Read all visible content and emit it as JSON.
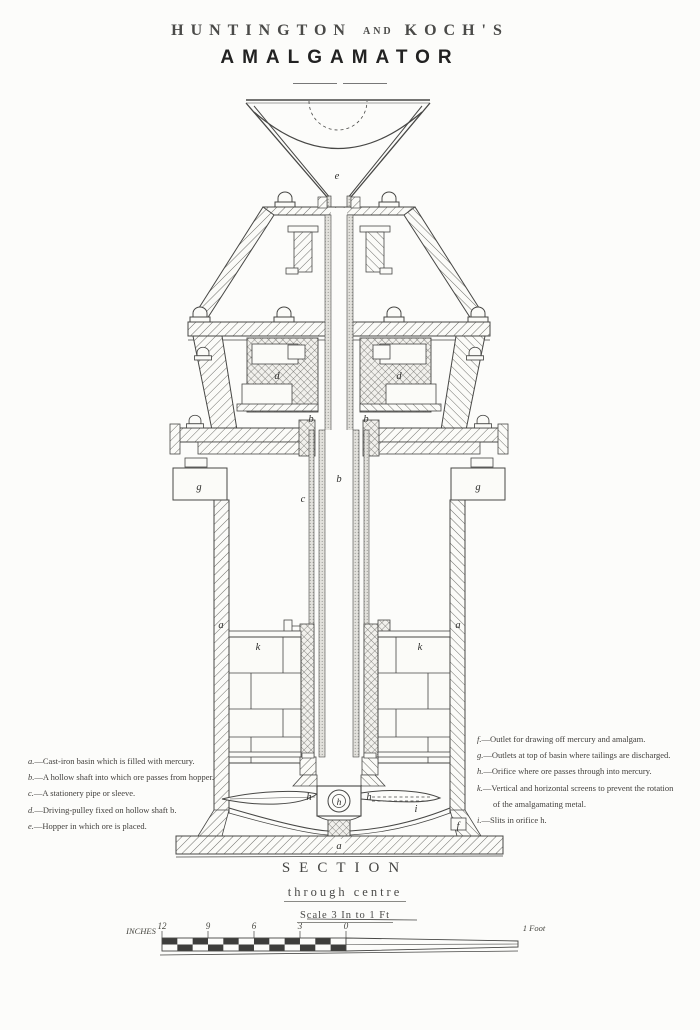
{
  "title": {
    "word1": "HUNTINGTON",
    "conj": "AND",
    "word2": "KOCH'S",
    "line2": "AMALGAMATOR"
  },
  "legend_left": [
    {
      "key": "a.",
      "text": "—Cast-iron basin which is filled with mercury."
    },
    {
      "key": "b.",
      "text": "—A hollow shaft into which ore passes from hopper."
    },
    {
      "key": "c.",
      "text": "—A stationery pipe or sleeve."
    },
    {
      "key": "d.",
      "text": "—Driving-pulley fixed on hollow shaft b."
    },
    {
      "key": "e.",
      "text": "—Hopper in which ore is placed."
    }
  ],
  "legend_right": [
    {
      "key": "f.",
      "text": "—Outlet for drawing off mercury and amalgam."
    },
    {
      "key": "g.",
      "text": "—Outlets at top of basin where tailings are discharged."
    },
    {
      "key": "h.",
      "text": "—Orifice where ore passes through into mercury."
    },
    {
      "key": "k.",
      "text": "—Vertical and horizontal screens to prevent the rotation"
    },
    {
      "key": "",
      "text": "of the amalgamating metal."
    },
    {
      "key": "i.",
      "text": "—Slits in orifice h."
    }
  ],
  "caption": {
    "line1": "SECTION",
    "line2": "through centre",
    "line3": "Scale 3 In to 1 Ft"
  },
  "scale_bar": {
    "left_label": "INCHES",
    "ticks": [
      "12",
      "9",
      "6",
      "3",
      "0"
    ],
    "right_label": "1 Foot"
  },
  "drawing_labels": {
    "hopper": "e",
    "pulley_left": "d",
    "pulley_right": "d",
    "shaft_left": "b",
    "shaft_right": "b",
    "shaft_bore": "b",
    "pipe": "c",
    "outlet_left": "g",
    "outlet_right": "g",
    "basin_left": "a",
    "basin_right": "a",
    "screen_left": "k",
    "screen_right": "k",
    "blade_left": "h",
    "hub": "h",
    "blade_right": "h",
    "slits": "i",
    "drain": "f",
    "base": "a"
  }
}
